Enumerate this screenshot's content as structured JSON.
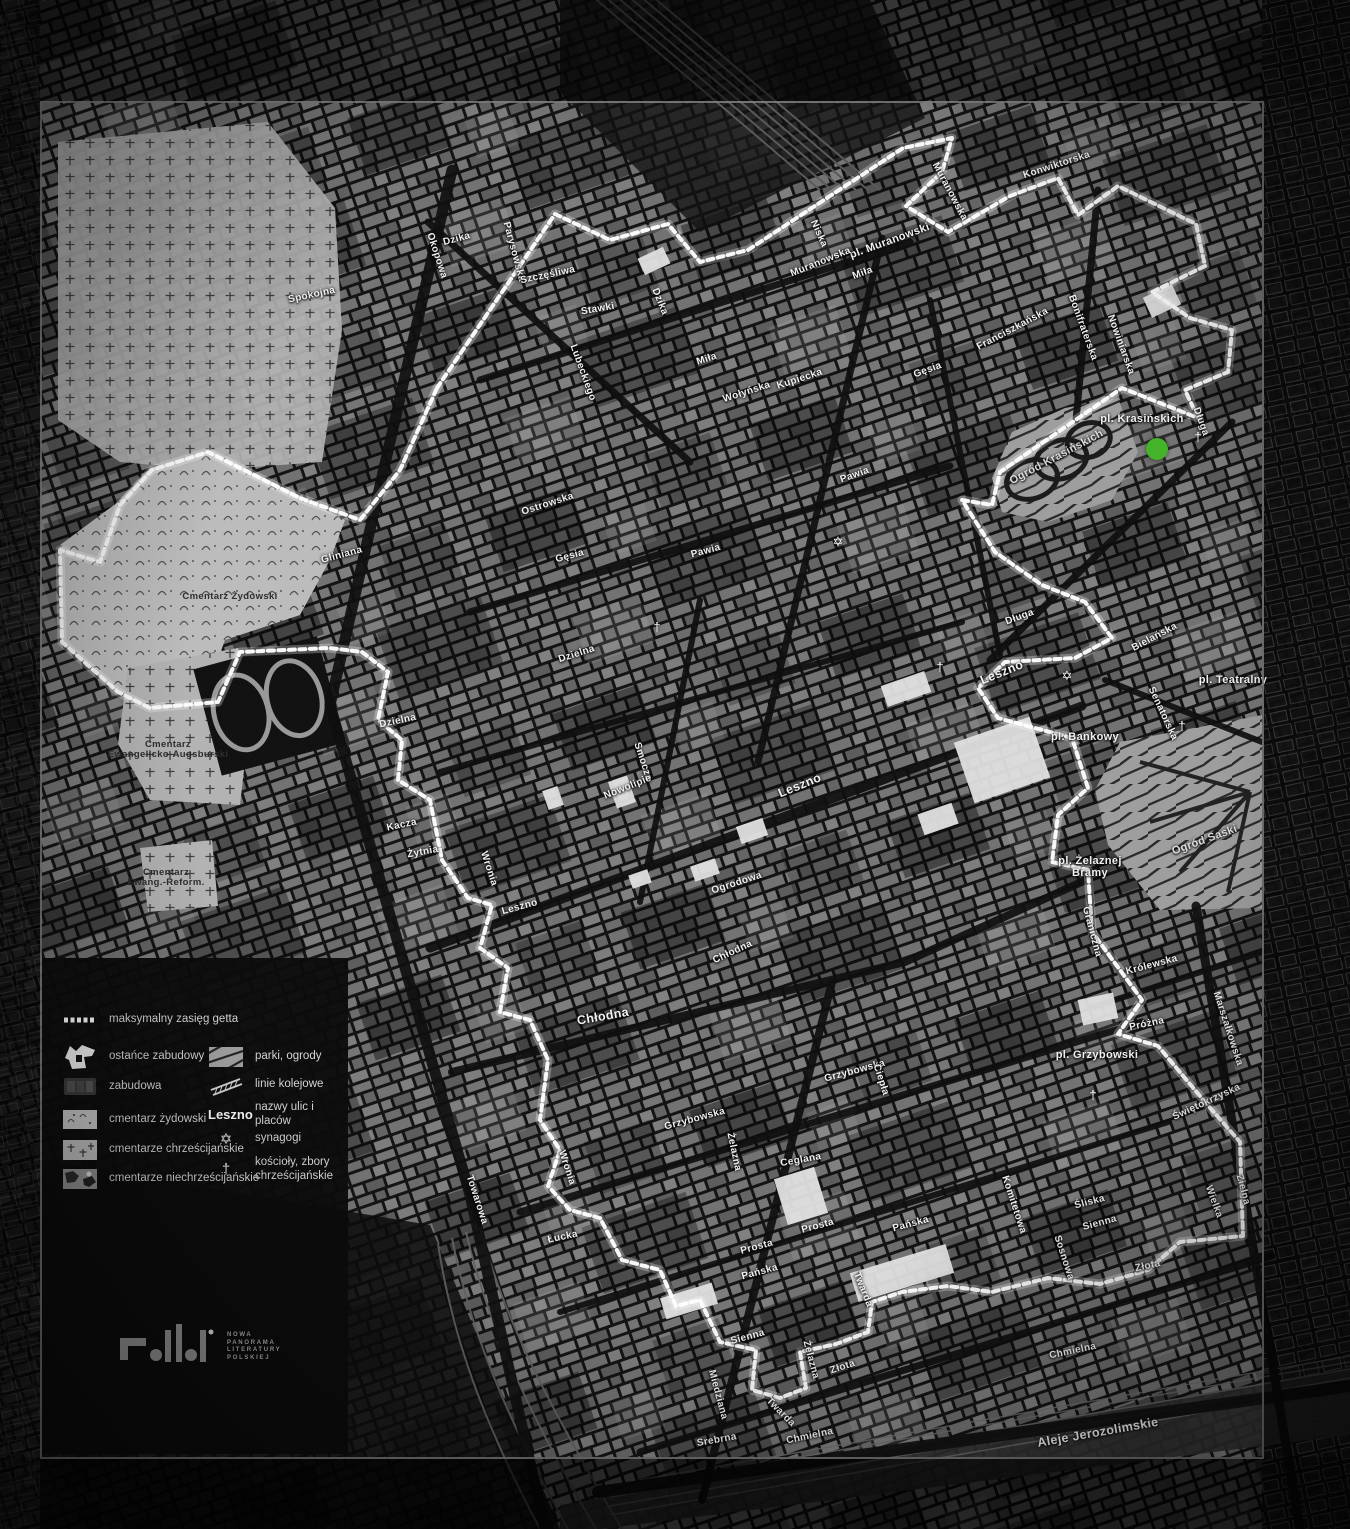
{
  "map": {
    "marker": {
      "x": 1157,
      "y": 449,
      "radius": 11,
      "color": "#45b32a"
    },
    "symbol_glyphs": {
      "synagogue": "✡",
      "church": "†"
    },
    "symbols": [
      {
        "type": "synagogue",
        "x": 838,
        "y": 542
      },
      {
        "type": "synagogue",
        "x": 1067,
        "y": 676
      },
      {
        "type": "church",
        "x": 657,
        "y": 627
      },
      {
        "type": "church",
        "x": 940,
        "y": 667
      },
      {
        "type": "church",
        "x": 1093,
        "y": 1095
      },
      {
        "type": "church",
        "x": 1198,
        "y": 437
      },
      {
        "type": "church",
        "x": 1182,
        "y": 726
      }
    ],
    "labels": [
      {
        "t": "Spokojna",
        "x": 312,
        "y": 296,
        "r": -12
      },
      {
        "t": "Dzika",
        "x": 457,
        "y": 240,
        "r": -15
      },
      {
        "t": "Okopowa",
        "x": 436,
        "y": 256,
        "r": 72
      },
      {
        "t": "Parysowska",
        "x": 513,
        "y": 252,
        "r": 75
      },
      {
        "t": "Szczęśliwa",
        "x": 548,
        "y": 276,
        "r": -12
      },
      {
        "t": "Stawki",
        "x": 598,
        "y": 310,
        "r": -10
      },
      {
        "t": "Dzika",
        "x": 659,
        "y": 302,
        "r": 68
      },
      {
        "t": "Muranowska",
        "x": 949,
        "y": 192,
        "r": 62
      },
      {
        "t": "Konwiktorska",
        "x": 1057,
        "y": 166,
        "r": -18
      },
      {
        "t": "pl. Muranowski",
        "x": 890,
        "y": 242,
        "r": -20,
        "k": "p"
      },
      {
        "t": "Niska",
        "x": 818,
        "y": 234,
        "r": 66
      },
      {
        "t": "Muranowska",
        "x": 821,
        "y": 263,
        "r": -22
      },
      {
        "t": "Miła",
        "x": 863,
        "y": 274,
        "r": -20
      },
      {
        "t": "Miła",
        "x": 707,
        "y": 360,
        "r": -18
      },
      {
        "t": "Kupiecka",
        "x": 800,
        "y": 380,
        "r": -18
      },
      {
        "t": "Wołyńska",
        "x": 747,
        "y": 393,
        "r": -18
      },
      {
        "t": "Lubeckiego",
        "x": 582,
        "y": 373,
        "r": 70
      },
      {
        "t": "Franciszkańska",
        "x": 1013,
        "y": 330,
        "r": -28
      },
      {
        "t": "Bonifraterska",
        "x": 1082,
        "y": 328,
        "r": 70
      },
      {
        "t": "Nowiniarska",
        "x": 1120,
        "y": 345,
        "r": 70
      },
      {
        "t": "pl. Krasińskich",
        "x": 1142,
        "y": 420,
        "r": 0,
        "k": "p"
      },
      {
        "t": "Długa",
        "x": 1200,
        "y": 422,
        "r": 70
      },
      {
        "t": "Ogród Krasińskich",
        "x": 1057,
        "y": 458,
        "r": -28,
        "k": "g"
      },
      {
        "t": "Gęsia",
        "x": 928,
        "y": 371,
        "r": -20
      },
      {
        "t": "Pawia",
        "x": 855,
        "y": 476,
        "r": -20
      },
      {
        "t": "Ostrowska",
        "x": 548,
        "y": 505,
        "r": -18
      },
      {
        "t": "Gęsia",
        "x": 570,
        "y": 557,
        "r": -15
      },
      {
        "t": "Pawia",
        "x": 706,
        "y": 552,
        "r": -15
      },
      {
        "t": "Cmentarz Żydowski",
        "x": 230,
        "y": 597,
        "r": 0,
        "k": "c"
      },
      {
        "t": "Gliniana",
        "x": 342,
        "y": 556,
        "r": -15
      },
      {
        "t": "Dzielna",
        "x": 577,
        "y": 655,
        "r": -18
      },
      {
        "t": "Dzielna",
        "x": 398,
        "y": 722,
        "r": -12
      },
      {
        "t": "Smocza",
        "x": 642,
        "y": 762,
        "r": 72
      },
      {
        "t": "Nowolipie",
        "x": 628,
        "y": 788,
        "r": -22
      },
      {
        "t": "Kacza",
        "x": 402,
        "y": 826,
        "r": -12
      },
      {
        "t": "Żytnia",
        "x": 423,
        "y": 853,
        "r": -10
      },
      {
        "t": "Wronia",
        "x": 488,
        "y": 869,
        "r": 72
      },
      {
        "t": "Leszno",
        "x": 520,
        "y": 908,
        "r": -15
      },
      {
        "t": "Leszno",
        "x": 800,
        "y": 786,
        "r": -22,
        "k": "m"
      },
      {
        "t": "Leszno",
        "x": 1002,
        "y": 673,
        "r": -22,
        "k": "m"
      },
      {
        "t": "Długa",
        "x": 1020,
        "y": 618,
        "r": -20
      },
      {
        "t": "Bielańska",
        "x": 1155,
        "y": 638,
        "r": -28
      },
      {
        "t": "pl. Teatralny",
        "x": 1233,
        "y": 681,
        "r": 0,
        "k": "p"
      },
      {
        "t": "Senatorska",
        "x": 1162,
        "y": 714,
        "r": 65
      },
      {
        "t": "pl. Bankowy",
        "x": 1085,
        "y": 738,
        "r": 0,
        "k": "p"
      },
      {
        "t": "Ogród Saski",
        "x": 1205,
        "y": 841,
        "r": -20,
        "k": "g"
      },
      {
        "t": "pl. Żelaznej\nBramy",
        "x": 1090,
        "y": 868,
        "r": 0,
        "k": "p"
      },
      {
        "t": "Graniczna",
        "x": 1091,
        "y": 932,
        "r": 75
      },
      {
        "t": "Królewska",
        "x": 1152,
        "y": 966,
        "r": -15
      },
      {
        "t": "Ogrodowa",
        "x": 737,
        "y": 884,
        "r": -18
      },
      {
        "t": "Chłodna",
        "x": 603,
        "y": 1017,
        "r": -10,
        "k": "m"
      },
      {
        "t": "Chłodna",
        "x": 733,
        "y": 953,
        "r": -25
      },
      {
        "t": "Wronia",
        "x": 566,
        "y": 1168,
        "r": 72
      },
      {
        "t": "Towarowa",
        "x": 476,
        "y": 1200,
        "r": 72
      },
      {
        "t": "Łucka",
        "x": 563,
        "y": 1238,
        "r": -12
      },
      {
        "t": "Grzybowska",
        "x": 695,
        "y": 1120,
        "r": -15
      },
      {
        "t": "Grzybowska",
        "x": 855,
        "y": 1072,
        "r": -15
      },
      {
        "t": "Ciepła",
        "x": 880,
        "y": 1080,
        "r": 72
      },
      {
        "t": "Żelazna",
        "x": 733,
        "y": 1152,
        "r": 78
      },
      {
        "t": "Ceglana",
        "x": 801,
        "y": 1161,
        "r": -10
      },
      {
        "t": "Prosta",
        "x": 757,
        "y": 1248,
        "r": -15
      },
      {
        "t": "Prosta",
        "x": 818,
        "y": 1227,
        "r": -15
      },
      {
        "t": "Pańska",
        "x": 760,
        "y": 1273,
        "r": -15
      },
      {
        "t": "Pańska",
        "x": 911,
        "y": 1225,
        "r": -15
      },
      {
        "t": "Śliska",
        "x": 1090,
        "y": 1203,
        "r": -15
      },
      {
        "t": "Sienna",
        "x": 1100,
        "y": 1224,
        "r": -15
      },
      {
        "t": "Sienna",
        "x": 748,
        "y": 1338,
        "r": -15
      },
      {
        "t": "Twarda",
        "x": 862,
        "y": 1290,
        "r": 68
      },
      {
        "t": "Twarda",
        "x": 780,
        "y": 1413,
        "r": 45
      },
      {
        "t": "Miedziana",
        "x": 717,
        "y": 1395,
        "r": 75
      },
      {
        "t": "Srebrna",
        "x": 717,
        "y": 1441,
        "r": -10
      },
      {
        "t": "Żelazna",
        "x": 810,
        "y": 1360,
        "r": 75
      },
      {
        "t": "Złota",
        "x": 1148,
        "y": 1267,
        "r": -12
      },
      {
        "t": "Złota",
        "x": 843,
        "y": 1368,
        "r": -18
      },
      {
        "t": "Sosnowa",
        "x": 1063,
        "y": 1258,
        "r": 72
      },
      {
        "t": "Komitetowa",
        "x": 1013,
        "y": 1205,
        "r": 72
      },
      {
        "t": "Chmielna",
        "x": 1073,
        "y": 1352,
        "r": -12
      },
      {
        "t": "Chmielna",
        "x": 810,
        "y": 1437,
        "r": -12
      },
      {
        "t": "Aleje Jerozolimskie",
        "x": 1098,
        "y": 1433,
        "r": -10,
        "k": "m"
      },
      {
        "t": "pl. Grzybowski",
        "x": 1097,
        "y": 1056,
        "r": 0,
        "k": "p"
      },
      {
        "t": "Próżna",
        "x": 1147,
        "y": 1025,
        "r": -12
      },
      {
        "t": "Marszałkowska",
        "x": 1227,
        "y": 1029,
        "r": 72
      },
      {
        "t": "Świętokrzyska",
        "x": 1207,
        "y": 1103,
        "r": -25
      },
      {
        "t": "Zielna",
        "x": 1242,
        "y": 1190,
        "r": 75
      },
      {
        "t": "Wielka",
        "x": 1213,
        "y": 1202,
        "r": 70
      },
      {
        "t": "Cmentarz\nEwangelicko-Augsburski",
        "x": 168,
        "y": 750,
        "r": 0,
        "k": "c"
      },
      {
        "t": "Cmentarz\nEwang.-Reform.",
        "x": 166,
        "y": 878,
        "r": 0,
        "k": "c"
      }
    ]
  },
  "legend": {
    "items": [
      {
        "label": "maksymalny zasięg getta"
      },
      {
        "label": "ostańce zabudowy"
      },
      {
        "label": "zabudowa"
      },
      {
        "label": "cmentarz żydowski"
      },
      {
        "label": "cmentarze chrześcijańskie"
      },
      {
        "label": "cmentarze niechrześcijańskie"
      },
      {
        "label": "parki, ogrody"
      },
      {
        "label": "linie kolejowe"
      },
      {
        "sample": "Leszno",
        "label": "nazwy ulic i placów"
      },
      {
        "symbol": "✡",
        "label": "synagogi"
      },
      {
        "symbol": "†",
        "label": "kościoły, zbory chrześcijańskie"
      }
    ]
  },
  "logo": {
    "lines": [
      "NOWA",
      "PANORAMA",
      "LITERATURY",
      "POLSKIEJ"
    ]
  }
}
